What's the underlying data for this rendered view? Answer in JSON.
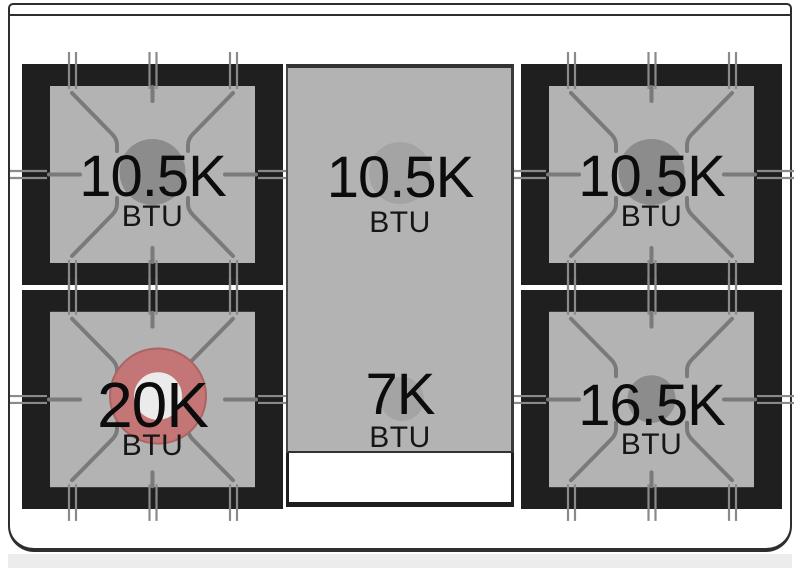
{
  "diagram": {
    "name": "range-cooktop-burner-layout",
    "unit_label": "BTU",
    "burners": [
      {
        "position": "back-left",
        "rating": "10.5K",
        "unit": "BTU",
        "style": "grate",
        "flame_color": "#8c8c8c"
      },
      {
        "position": "back-center",
        "rating": "10.5K",
        "unit": "BTU",
        "style": "griddle",
        "flame_color": "#a4a4a4"
      },
      {
        "position": "back-right",
        "rating": "10.5K",
        "unit": "BTU",
        "style": "grate",
        "flame_color": "#8c8c8c"
      },
      {
        "position": "front-left",
        "rating": "20K",
        "unit": "BTU",
        "style": "grate-dual-ring",
        "flame_color": "#c47676",
        "flame_center_color": "#ebebeb"
      },
      {
        "position": "front-center",
        "rating": "7K",
        "unit": "BTU",
        "style": "griddle",
        "flame_color": "#a4a4a4"
      },
      {
        "position": "front-right",
        "rating": "16.5K",
        "unit": "BTU",
        "style": "grate",
        "flame_color": "#8c8c8c"
      }
    ],
    "colors": {
      "frame_black": "#1f1f1f",
      "grate_surface_gray": "#b3b3b3",
      "grate_line_gray": "#7a7a7a",
      "standard_flame_gray": "#8c8c8c",
      "griddle_flame_gray": "#a4a4a4",
      "power_burner_red": "#c47676",
      "body_outline": "#2e2e2e"
    }
  }
}
